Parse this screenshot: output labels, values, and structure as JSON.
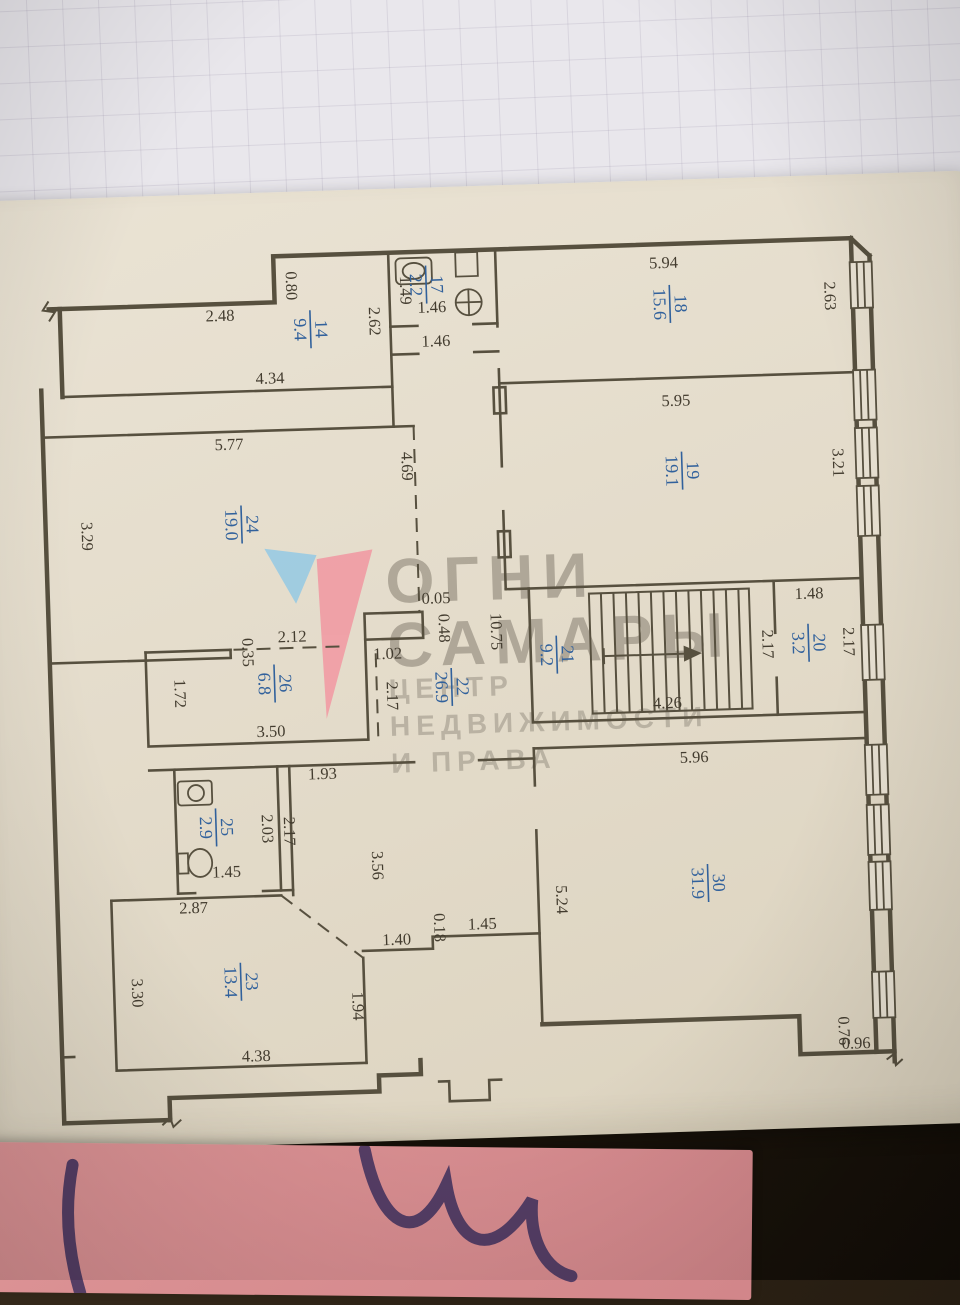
{
  "plan": {
    "title_hint": "apartment floor plan photo",
    "rooms": [
      {
        "number": "14",
        "area": "9.4",
        "x": 285,
        "y": 112
      },
      {
        "number": "17",
        "area": "2.2",
        "x": 402,
        "y": 71
      },
      {
        "number": "18",
        "area": "15.6",
        "x": 645,
        "y": 98
      },
      {
        "number": "19",
        "area": "19.1",
        "x": 652,
        "y": 265
      },
      {
        "number": "24",
        "area": "19.0",
        "x": 210,
        "y": 305
      },
      {
        "number": "26",
        "area": "6.8",
        "x": 238,
        "y": 465
      },
      {
        "number": "22",
        "area": "26.9",
        "x": 415,
        "y": 474
      },
      {
        "number": "21",
        "area": "9.2",
        "x": 521,
        "y": 445
      },
      {
        "number": "20",
        "area": "3.2",
        "x": 773,
        "y": 441
      },
      {
        "number": "25",
        "area": "2.9",
        "x": 175,
        "y": 607
      },
      {
        "number": "23",
        "area": "13.4",
        "x": 195,
        "y": 762
      },
      {
        "number": "30",
        "area": "31.9",
        "x": 665,
        "y": 678
      }
    ],
    "dimensions": [
      {
        "text": "2.48",
        "x": 195,
        "y": 101,
        "rot": 0
      },
      {
        "text": "0.80",
        "x": 262,
        "y": 68,
        "rot": 90
      },
      {
        "text": "1.49",
        "x": 376,
        "y": 76,
        "rot": 90
      },
      {
        "text": "2.62",
        "x": 344,
        "y": 106,
        "rot": 90
      },
      {
        "text": "4.34",
        "x": 243,
        "y": 165,
        "rot": 0
      },
      {
        "text": "1.46",
        "x": 407,
        "y": 99,
        "rot": 0
      },
      {
        "text": "1.46",
        "x": 410,
        "y": 133,
        "rot": 0
      },
      {
        "text": "5.94",
        "x": 640,
        "y": 62,
        "rot": 0
      },
      {
        "text": "2.63",
        "x": 800,
        "y": 95,
        "rot": 90
      },
      {
        "text": "5.95",
        "x": 648,
        "y": 200,
        "rot": 0
      },
      {
        "text": "3.21",
        "x": 803,
        "y": 262,
        "rot": 90
      },
      {
        "text": "5.77",
        "x": 200,
        "y": 230,
        "rot": 0
      },
      {
        "text": "3.29",
        "x": 50,
        "y": 312,
        "rot": 90
      },
      {
        "text": "4.69",
        "x": 372,
        "y": 252,
        "rot": 90
      },
      {
        "text": "0.05",
        "x": 402,
        "y": 390,
        "rot": 0
      },
      {
        "text": "0.48",
        "x": 404,
        "y": 415,
        "rot": 90
      },
      {
        "text": "1.02",
        "x": 352,
        "y": 444,
        "rot": 0
      },
      {
        "text": "2.12",
        "x": 257,
        "y": 424,
        "rot": 0
      },
      {
        "text": "0.35",
        "x": 207,
        "y": 433,
        "rot": 90
      },
      {
        "text": "1.72",
        "x": 138,
        "y": 472,
        "rot": 90
      },
      {
        "text": "2.17",
        "x": 350,
        "y": 481,
        "rot": 90
      },
      {
        "text": "3.50",
        "x": 233,
        "y": 518,
        "rot": 0
      },
      {
        "text": "10.75",
        "x": 456,
        "y": 420,
        "rot": 90
      },
      {
        "text": "2.17",
        "x": 727,
        "y": 441,
        "rot": 90
      },
      {
        "text": "1.48",
        "x": 775,
        "y": 397,
        "rot": 0
      },
      {
        "text": "2.17",
        "x": 808,
        "y": 441,
        "rot": 90
      },
      {
        "text": "4.26",
        "x": 630,
        "y": 502,
        "rot": 0
      },
      {
        "text": "5.96",
        "x": 655,
        "y": 557,
        "rot": 0
      },
      {
        "text": "5.24",
        "x": 513,
        "y": 690,
        "rot": 90
      },
      {
        "text": "1.93",
        "x": 283,
        "y": 562,
        "rot": 0
      },
      {
        "text": "2.03",
        "x": 221,
        "y": 610,
        "rot": 90
      },
      {
        "text": "2.17",
        "x": 243,
        "y": 613,
        "rot": 90
      },
      {
        "text": "1.45",
        "x": 184,
        "y": 657,
        "rot": 0
      },
      {
        "text": "2.87",
        "x": 150,
        "y": 692,
        "rot": 0
      },
      {
        "text": "3.56",
        "x": 330,
        "y": 650,
        "rot": 90
      },
      {
        "text": "1.40",
        "x": 352,
        "y": 730,
        "rot": 0
      },
      {
        "text": "0.18",
        "x": 390,
        "y": 714,
        "rot": 90
      },
      {
        "text": "1.45",
        "x": 438,
        "y": 717,
        "rot": 0
      },
      {
        "text": "1.94",
        "x": 306,
        "y": 790,
        "rot": 90
      },
      {
        "text": "3.30",
        "x": 86,
        "y": 770,
        "rot": 90
      },
      {
        "text": "4.38",
        "x": 208,
        "y": 842,
        "rot": 0
      },
      {
        "text": "0.76",
        "x": 791,
        "y": 830,
        "rot": 90
      },
      {
        "text": "0.96",
        "x": 808,
        "y": 848,
        "rot": 0
      }
    ]
  },
  "watermark": {
    "brand_top": "ОГНИ",
    "brand_bottom": "САМАРЫ",
    "tagline1": "ЦЕНТР",
    "tagline2": "НЕДВИЖИМОСТИ",
    "tagline3": "И ПРАВА",
    "logo_blue": "#8fc9e6",
    "logo_red": "#f2939f"
  },
  "colors": {
    "wall_line": "#57503f",
    "dimension_text": "#433c2f",
    "room_label_blue": "#31619c",
    "plan_paper": "#e6dfcf",
    "notebook_paper": "#e9e7ec",
    "sticky_note": "#d88e91",
    "pen_ink": "#42325e",
    "background_dark": "#241b10"
  }
}
